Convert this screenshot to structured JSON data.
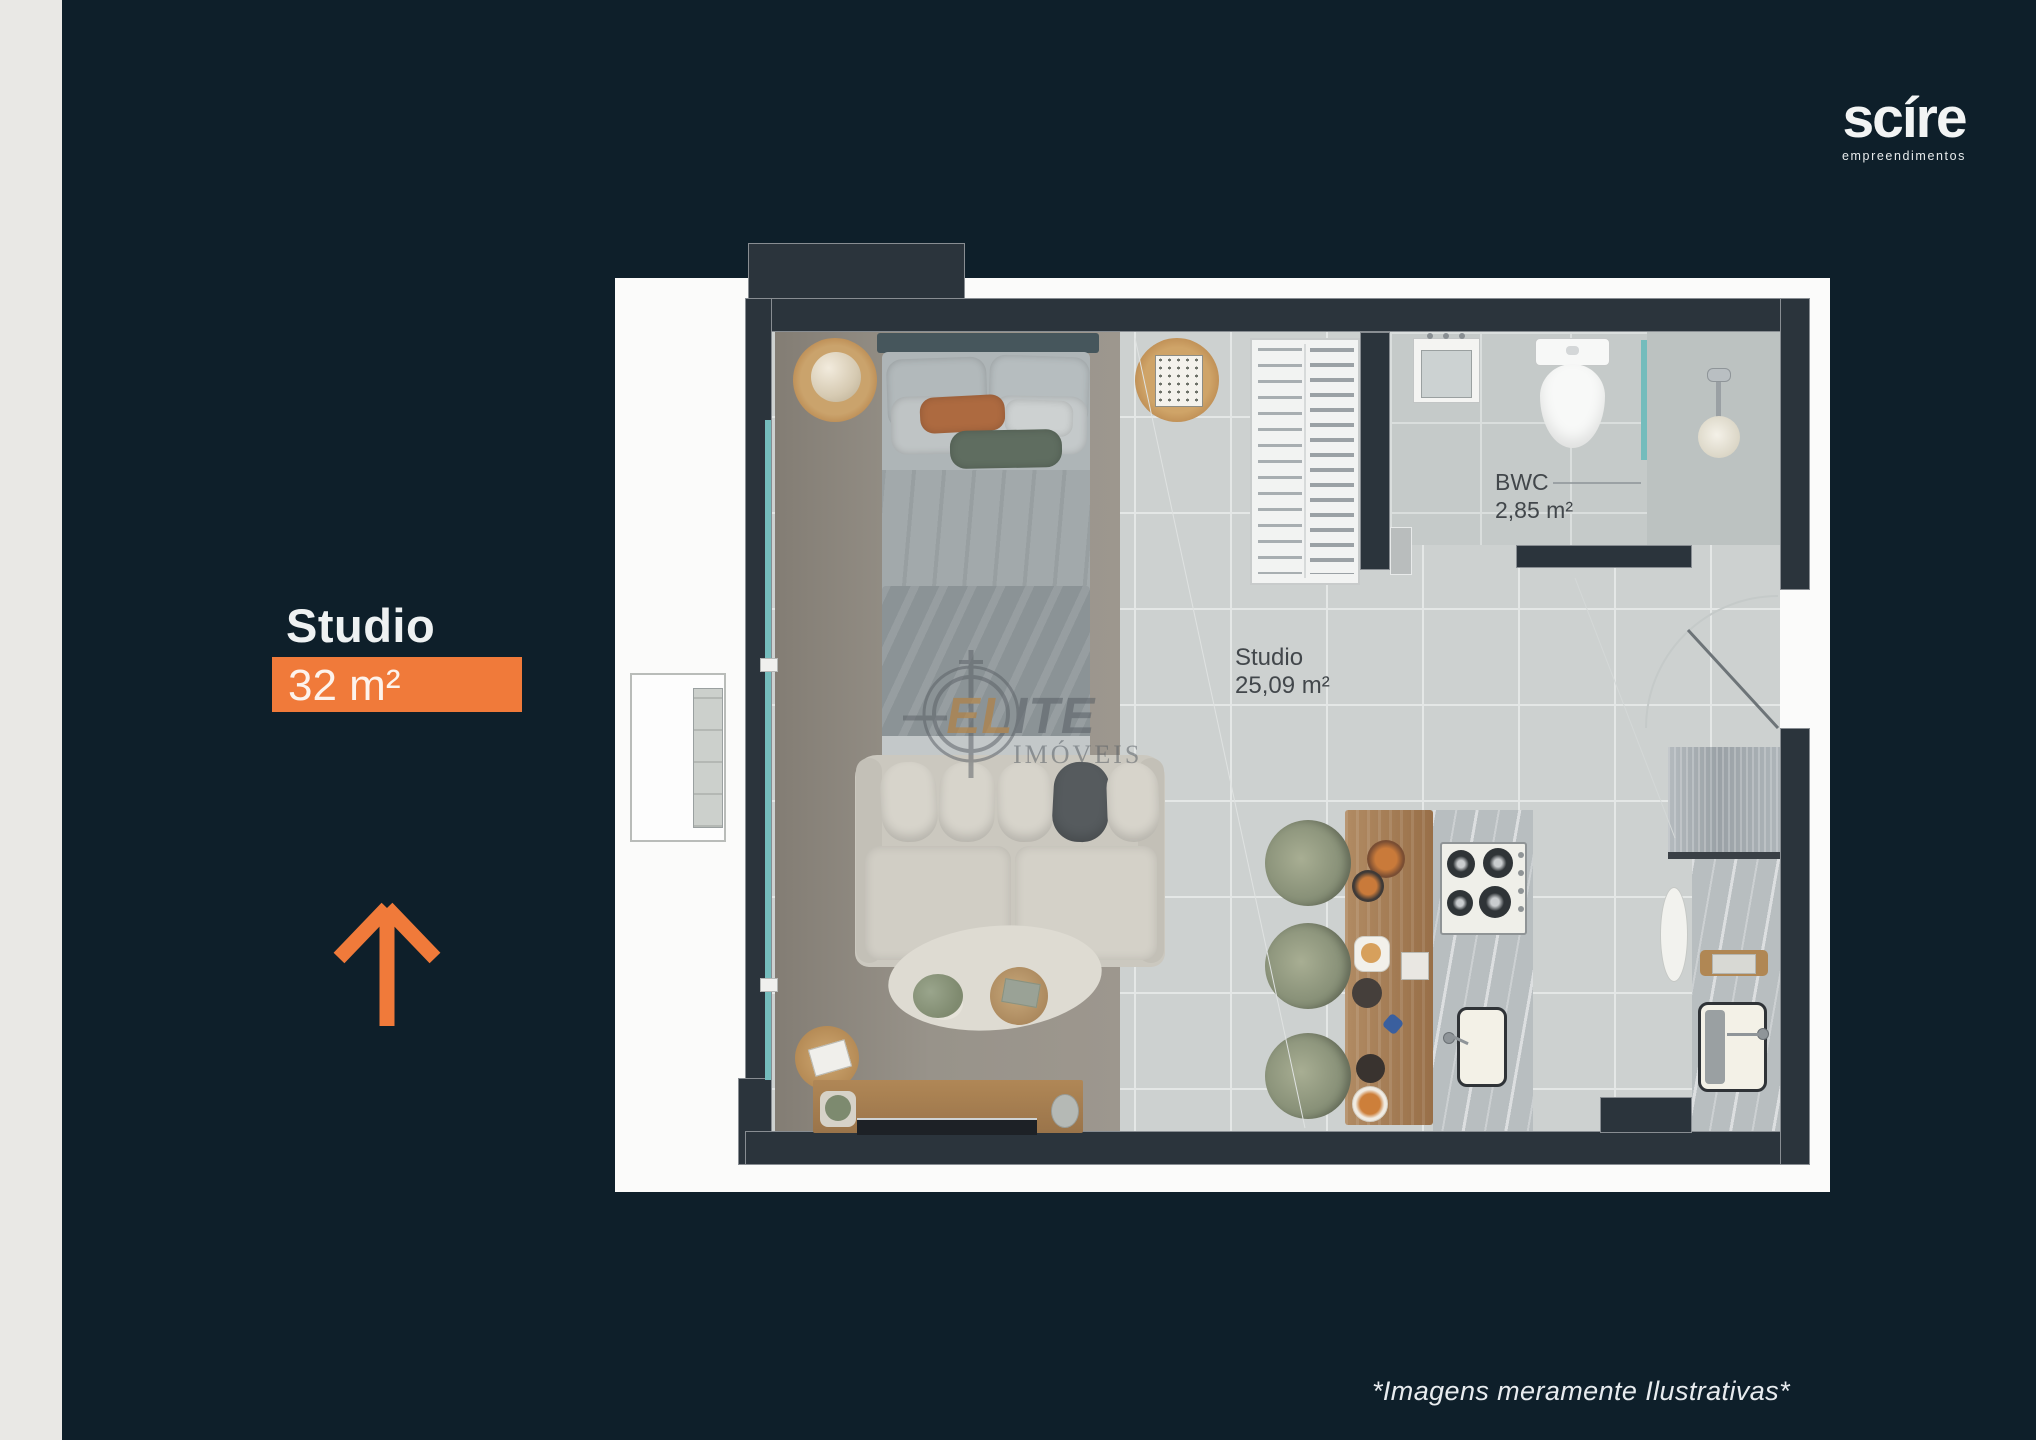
{
  "brand": {
    "name": "scíre",
    "tagline": "empreendimentos"
  },
  "unit": {
    "title": "Studio",
    "area": "32 m²"
  },
  "plan": {
    "studio": {
      "label": "Studio",
      "area": "25,09 m²"
    },
    "bwc": {
      "label": "BWC",
      "area": "2,85 m²"
    }
  },
  "watermark": {
    "brand_start": "EL",
    "brand_end": "ITE",
    "subtitle": "IMÓVEIS"
  },
  "footer": {
    "disclaimer": "*Imagens meramente Ilustrativas*"
  },
  "icons": {
    "north_arrow": "arrow-up",
    "watermark_logo": "crosshair-target"
  },
  "colors": {
    "background": "#0e1f2a",
    "accent_orange": "#f07a3a",
    "wall_charcoal": "#2b343c",
    "glass_teal": "#74bcbc",
    "watermark_orange": "#bf7c28",
    "side_strip": "#e9e8e5"
  }
}
